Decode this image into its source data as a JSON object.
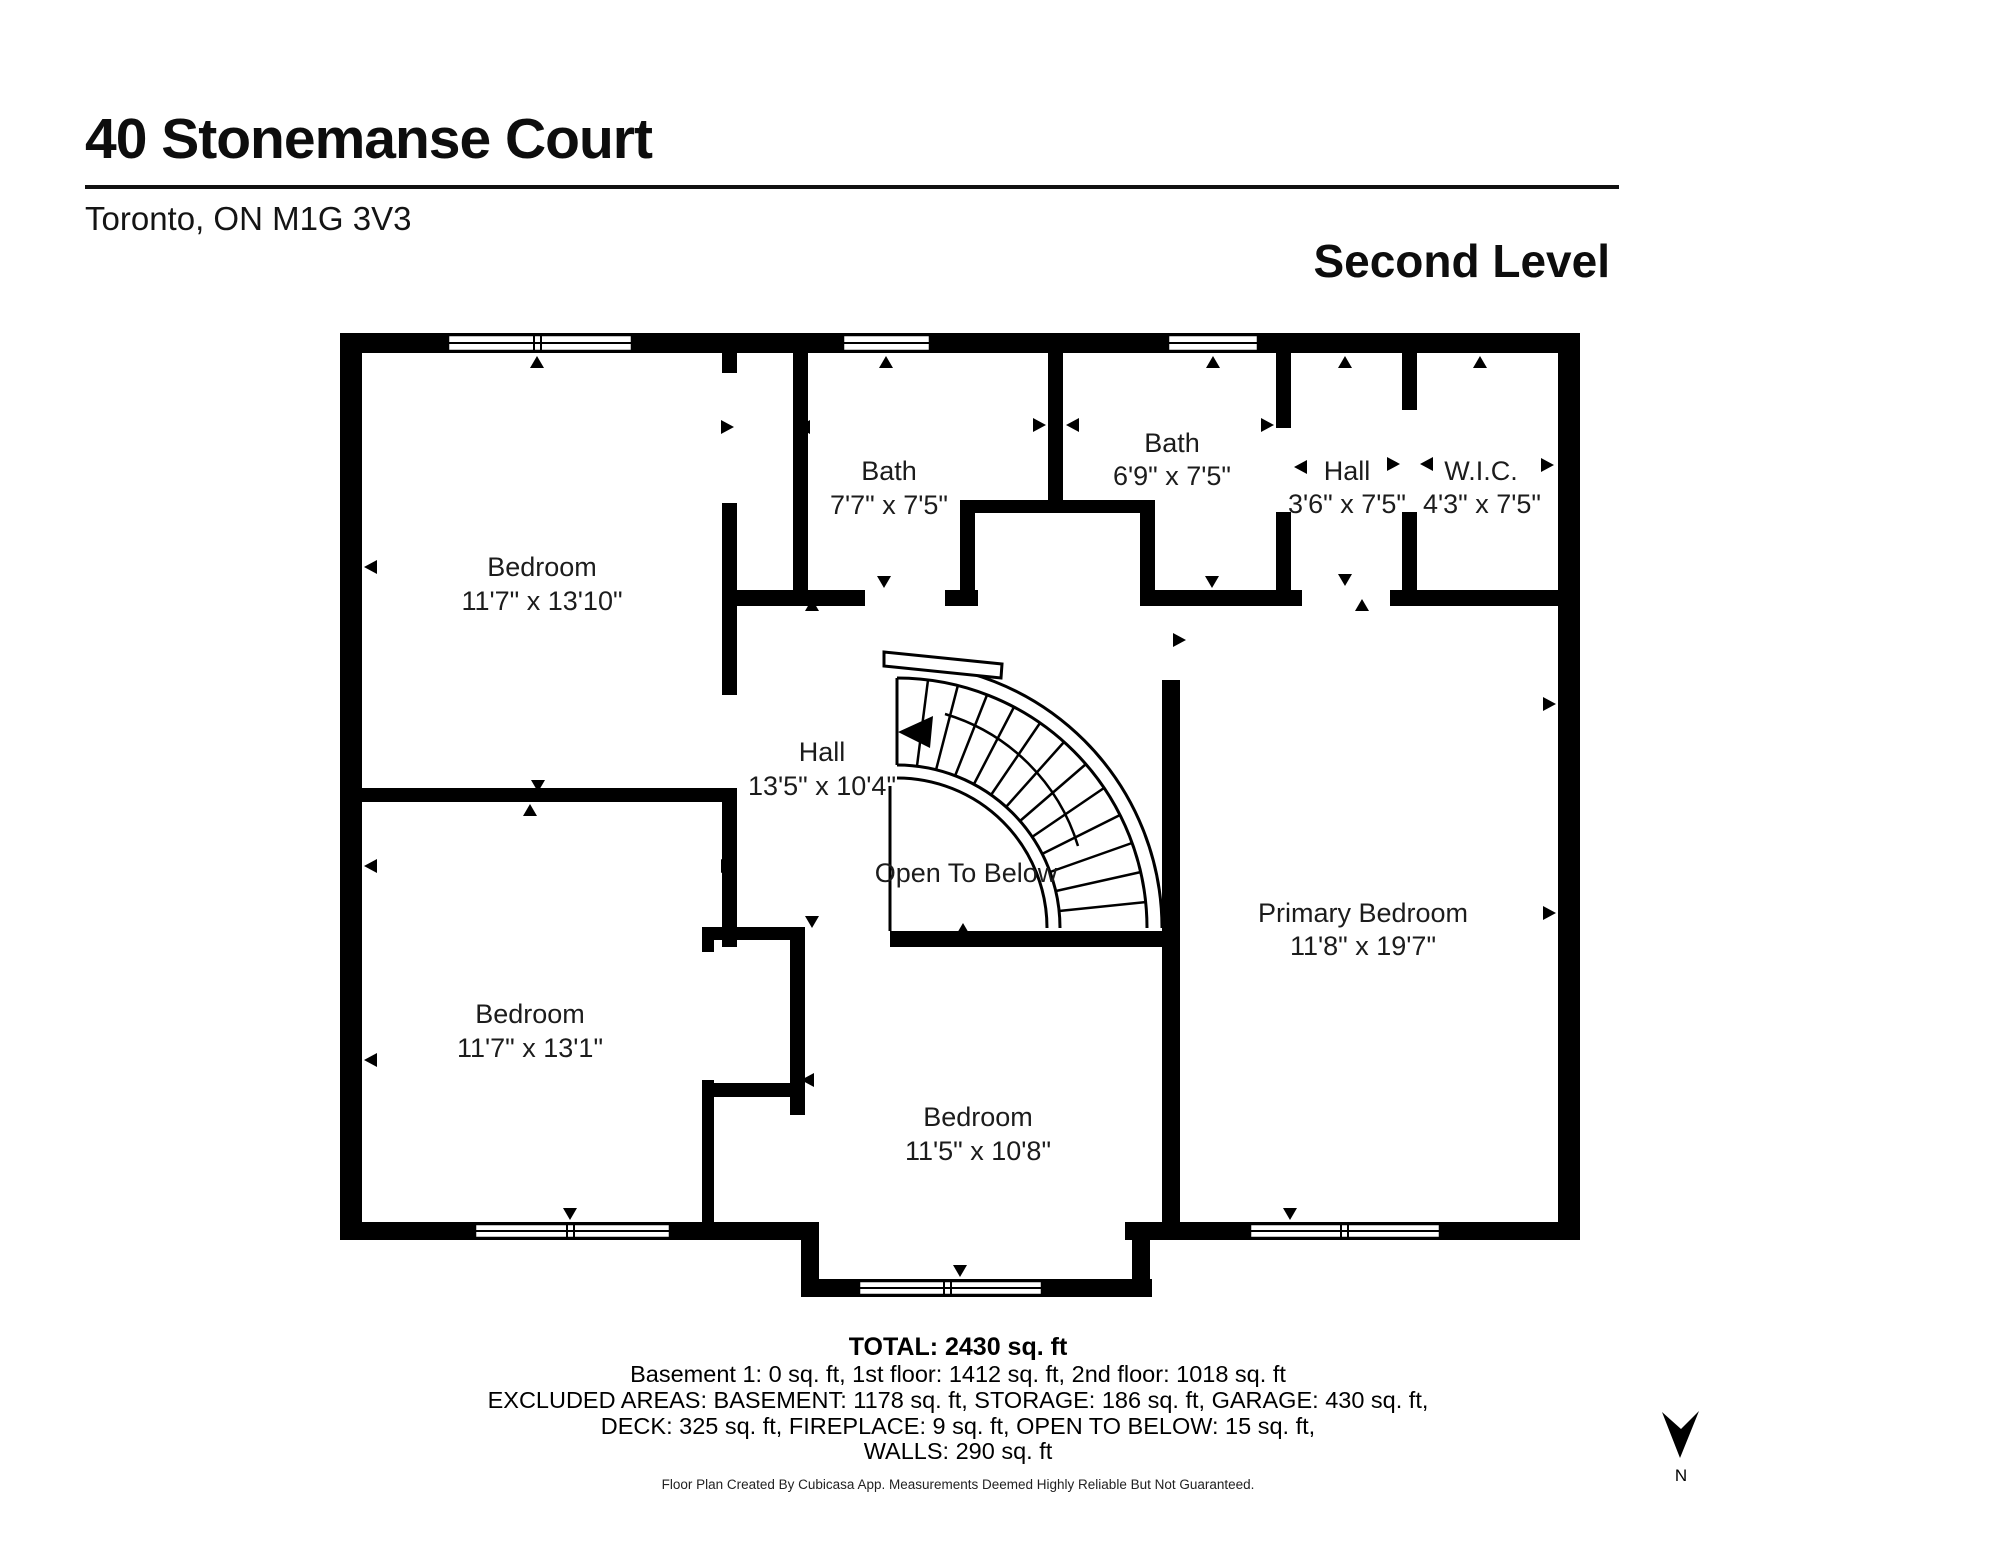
{
  "header": {
    "title": "40 Stonemanse Court",
    "subtitle": "Toronto, ON  M1G 3V3",
    "level_label": "Second Level"
  },
  "rooms": [
    {
      "id": "bedroom-top-left",
      "name": "Bedroom",
      "dims": "11'7\" x 13'10\""
    },
    {
      "id": "bath-1",
      "name": "Bath",
      "dims": "7'7\" x 7'5\""
    },
    {
      "id": "bath-2",
      "name": "Bath",
      "dims": "6'9\" x 7'5\""
    },
    {
      "id": "hall-top",
      "name": "Hall",
      "dims": "3'6\" x 7'5\""
    },
    {
      "id": "wic",
      "name": "W.I.C.",
      "dims": "4'3\" x 7'5\""
    },
    {
      "id": "hall-stairs",
      "name": "Hall",
      "dims": "13'5\" x 10'4\""
    },
    {
      "id": "open-to-below",
      "name": "Open To Below",
      "dims": ""
    },
    {
      "id": "primary-bedroom",
      "name": "Primary Bedroom",
      "dims": "11'8\" x 19'7\""
    },
    {
      "id": "bedroom-bottom-left",
      "name": "Bedroom",
      "dims": "11'7\" x 13'1\""
    },
    {
      "id": "bedroom-bottom-center",
      "name": "Bedroom",
      "dims": "11'5\" x 10'8\""
    }
  ],
  "footer": {
    "total": "TOTAL: 2430 sq. ft",
    "lines": [
      "Basement 1: 0 sq. ft, 1st floor: 1412 sq. ft, 2nd floor: 1018 sq. ft",
      "EXCLUDED AREAS: BASEMENT: 1178 sq. ft, STORAGE: 186 sq. ft, GARAGE: 430 sq. ft,",
      "DECK: 325 sq. ft, FIREPLACE: 9 sq. ft, OPEN TO BELOW: 15 sq. ft,",
      "WALLS: 290 sq. ft"
    ],
    "disclaimer": "Floor Plan Created By Cubicasa App. Measurements Deemed Highly Reliable But Not Guaranteed."
  },
  "compass": {
    "label": "N"
  },
  "colors": {
    "wall": "#000000",
    "background": "#ffffff",
    "text": "#1c1c1c"
  }
}
